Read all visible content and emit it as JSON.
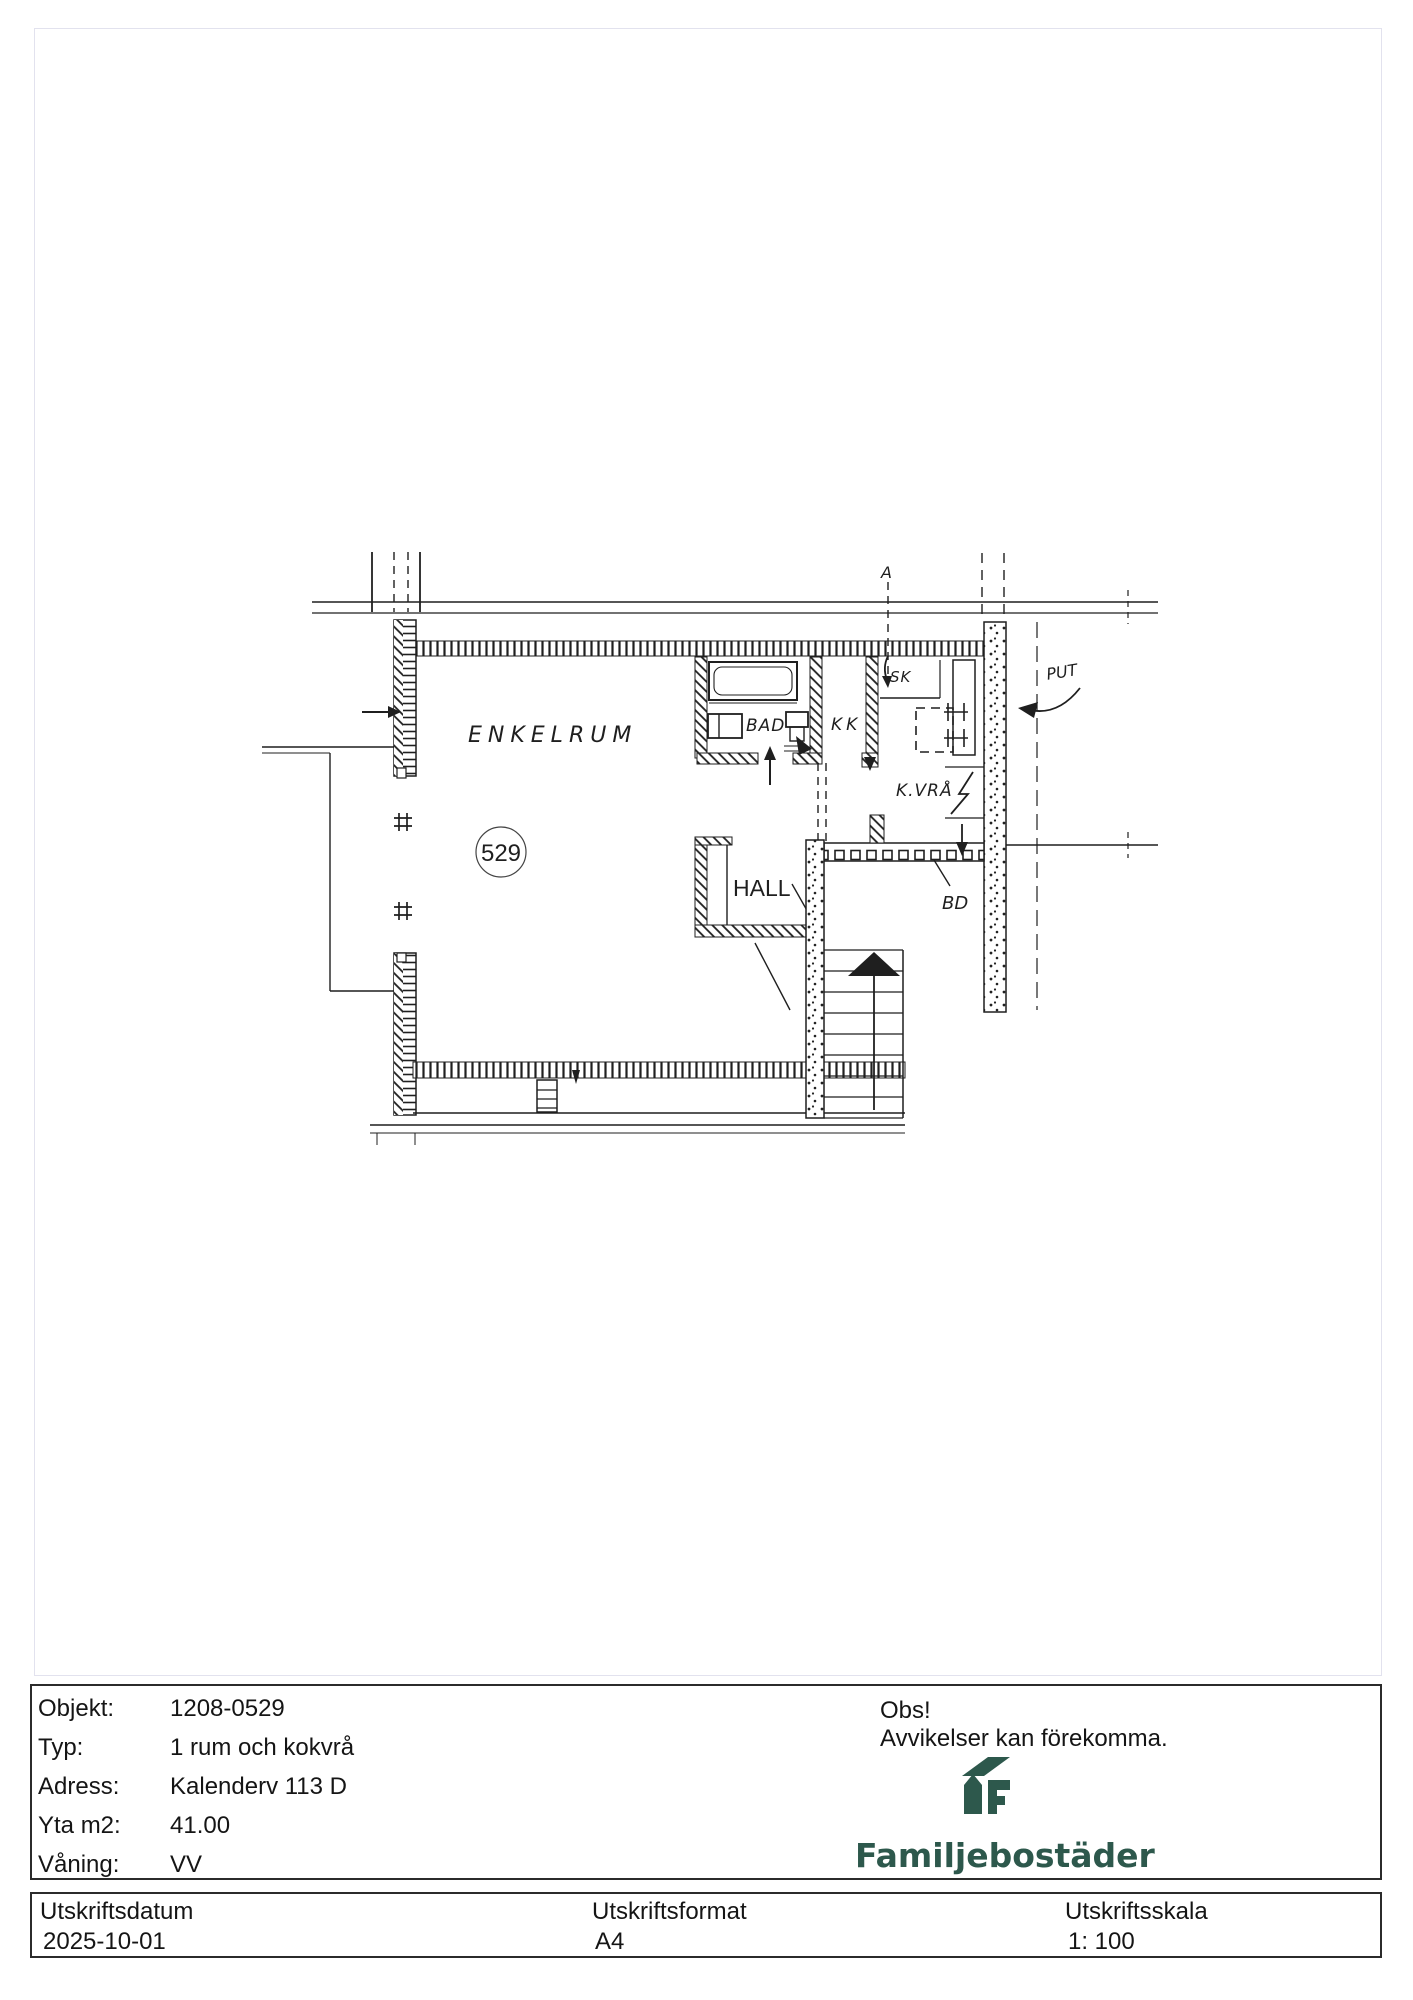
{
  "plan": {
    "labels": {
      "room": "ENKELRUM",
      "apartment_number": "529",
      "bath": "BAD",
      "kitchen": "KK",
      "closet": "SK",
      "cooking_nook": "K.VRÅ",
      "hall": "HALL",
      "bd": "BD",
      "put": "PUT",
      "section_mark": "A"
    }
  },
  "info": {
    "rows": [
      {
        "label": "Objekt:",
        "value": "1208-0529"
      },
      {
        "label": "Typ:",
        "value": "1 rum och kokvrå"
      },
      {
        "label": "Adress:",
        "value": "Kalenderv 113 D"
      },
      {
        "label": "Yta m2:",
        "value": "41.00"
      },
      {
        "label": "Våning:",
        "value": "VV"
      }
    ],
    "notice": {
      "title": "Obs!",
      "text": "Avvikelser kan förekomma."
    },
    "brand": {
      "name": "Familjebostäder",
      "color": "#2d584c"
    }
  },
  "footer": {
    "columns": [
      {
        "label": "Utskriftsdatum",
        "value": "2025-10-01"
      },
      {
        "label": "Utskriftsformat",
        "value": "A4"
      },
      {
        "label": "Utskriftsskala",
        "value": "1: 100"
      }
    ]
  }
}
